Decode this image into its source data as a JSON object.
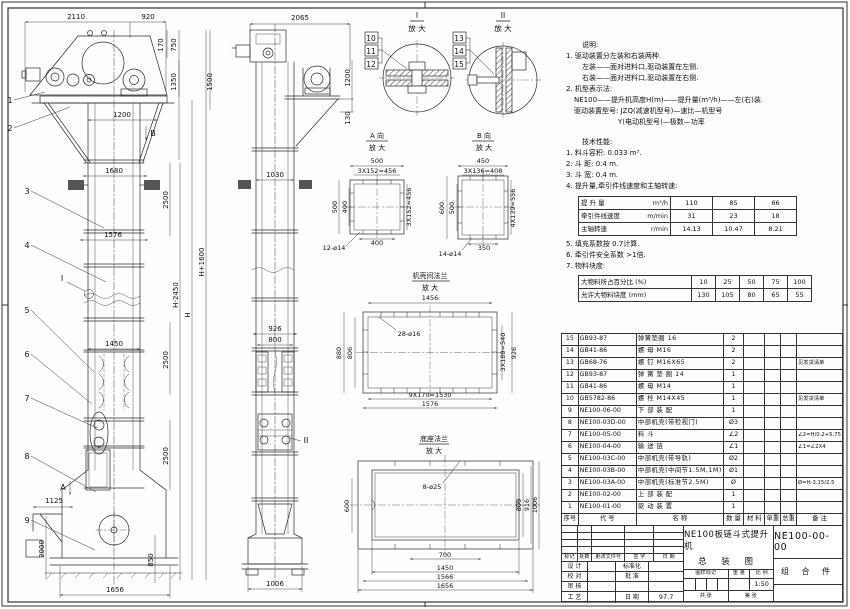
{
  "notes": {
    "heading": "说明:",
    "lines": [
      "1. 驱动装置分左装和右装两种.",
      "左装——面对进料口,驱动装置在左侧.",
      "右装——面对进料口,驱动装置在右侧.",
      "2. 机型表示法:",
      "NE100——提升机高度H(m)——提升量(m³/h)——左(右)装.",
      "驱动装置型号: JZQ(减速机型号)—速比—机型号",
      "Y(电动机型号)—极数—功率"
    ]
  },
  "performance": {
    "heading": "技术性能:",
    "items": [
      "1. 料斗容积: 0.033 m³.",
      "2. 斗  距: 0.4 m.",
      "3. 斗  宽: 0.4 m.",
      "4. 提升量,牵引件线速度和主轴转速:",
      "5. 填充系数按 0.7计算.",
      "6. 牵引件安全系数 >1倍.",
      "7. 物料块度:"
    ],
    "capacity_table": {
      "rows": [
        {
          "label": "提 升 量",
          "unit": "m³/h",
          "v1": "110",
          "v2": "85",
          "v3": "66"
        },
        {
          "label": "牵引件线速度",
          "unit": "m/min",
          "v1": "31",
          "v2": "23",
          "v3": "18"
        },
        {
          "label": "主轴转速",
          "unit": "r/min",
          "v1": "14.13",
          "v2": "10.47",
          "v3": "8.21"
        }
      ]
    },
    "lump_table": {
      "row1_label": "大物料所占百分比 (%)",
      "row1": [
        "10",
        "25",
        "50",
        "75",
        "100"
      ],
      "row2_label": "允许大物料块度 (mm)",
      "row2": [
        "130",
        "105",
        "80",
        "65",
        "55"
      ]
    }
  },
  "bom": {
    "headers": {
      "no": "序号",
      "code": "代  号",
      "name": "名    称",
      "qty": "数 量",
      "material": "材  料",
      "unit_weight": "单重",
      "total_weight": "总重",
      "remark": "备 注"
    },
    "rows": [
      {
        "no": "15",
        "code": "GB93-87",
        "name": "弹簧垫圈  16",
        "qty": "2",
        "remark": ""
      },
      {
        "no": "14",
        "code": "GB41-86",
        "name": "螺  母  M16",
        "qty": "2",
        "remark": ""
      },
      {
        "no": "13",
        "code": "GB68-76",
        "name": "螺  钉  M16X65",
        "qty": "2",
        "remark": "见发货清单"
      },
      {
        "no": "12",
        "code": "GB93-87",
        "name": "弹 簧 垫 圈  14",
        "qty": "1",
        "remark": ""
      },
      {
        "no": "11",
        "code": "GB41-86",
        "name": "螺  母  M14",
        "qty": "1",
        "remark": ""
      },
      {
        "no": "10",
        "code": "GB5782-86",
        "name": "螺  栓  M14X45",
        "qty": "1",
        "remark": "见发货清单"
      },
      {
        "no": "9",
        "code": "NE100-06-00",
        "name": "下 部 装 配",
        "qty": "1",
        "remark": ""
      },
      {
        "no": "8",
        "code": "NE100-03D-00",
        "name": "中部机壳(带检视门)",
        "qty": "Ø3",
        "remark": ""
      },
      {
        "no": "7",
        "code": "NE100-05-00",
        "name": "料  斗",
        "qty": "∠2",
        "remark": "∠2=H/0.2+5.75"
      },
      {
        "no": "6",
        "code": "NE100-04-00",
        "name": "输 送 链",
        "qty": "∠1",
        "remark": "∠1=∠2X4"
      },
      {
        "no": "5",
        "code": "NE100-03C-00",
        "name": "中部机壳(带导轨)",
        "qty": "Ø2",
        "remark": ""
      },
      {
        "no": "4",
        "code": "NE100-03B-00",
        "name": "中部机壳(中间节1.5M,1M)",
        "qty": "Ø1",
        "remark": ""
      },
      {
        "no": "3",
        "code": "NE100-03A-00",
        "name": "中部机壳(标准节2.5M)",
        "qty": "Ø",
        "remark": "Ø=H-3.15/2.5"
      },
      {
        "no": "2",
        "code": "NE100-02-00",
        "name": "上 部 装 配",
        "qty": "1",
        "remark": ""
      },
      {
        "no": "1",
        "code": "NE100-01-00",
        "name": "驱 动 装 置",
        "qty": "1",
        "remark": ""
      }
    ]
  },
  "title_block": {
    "product": "NE100板链斗式提升机",
    "doc_type": "总 装 图",
    "drawing_no": "NE100-00-00",
    "assembly": "组 合 件",
    "rev_headers": [
      "标记",
      "处数",
      "更改文件号",
      "签 字",
      "日 期"
    ],
    "roles": {
      "design": "设 计",
      "check": "校 对",
      "review": "审 核",
      "process": "工 艺",
      "standard": "标准化",
      "approve": "批 准",
      "date_label": "日 期",
      "date": "97.7"
    },
    "stamp": {
      "mark": "图样标记",
      "weight": "重 量",
      "scale_label": "比 例",
      "scale": "1:50",
      "sheets": "共  张",
      "sheet_no": "第  张"
    }
  },
  "front": {
    "dims": {
      "w2110": "2110",
      "w920": "920",
      "h170": "170",
      "h750": "750",
      "h1350": "1350",
      "h1500": "1500",
      "w1200": "1200",
      "w1680": "1680",
      "h2500a": "2500",
      "w1576": "1576",
      "hp1600": "H+1600",
      "hm2450": "H-2450",
      "h": "H",
      "w1450": "1450",
      "h2500b": "2500",
      "h2500c": "2500",
      "w1125": "1125",
      "h2000": "2000",
      "h850": "850",
      "w1656": "1656"
    },
    "balloons": [
      "1",
      "2",
      "3",
      "4",
      "5",
      "6",
      "7",
      "8",
      "9"
    ],
    "marker_a": "A",
    "marker_b": "B",
    "detail_ref_i": "I"
  },
  "side": {
    "dims": {
      "w2065": "2065",
      "h1200": "1200",
      "h130": "130",
      "w1030": "1030",
      "w926": "926",
      "w800": "800",
      "w1006": "1006"
    },
    "detail_ref_ii": "II"
  },
  "detail_i": {
    "label": "I",
    "zoom": "放 大",
    "balloons": [
      "10",
      "11",
      "12"
    ]
  },
  "detail_ii": {
    "label": "II",
    "zoom": "放 大",
    "balloons": [
      "13",
      "14",
      "15"
    ]
  },
  "view_a": {
    "title": "A 向",
    "zoom": "放 大",
    "dims": {
      "top": "500",
      "top2": "3X152=456",
      "left": "500",
      "left2": "400",
      "right": "3X152=456",
      "bottom": "400",
      "holes": "12-ø14"
    }
  },
  "view_b": {
    "title": "B 向",
    "zoom": "放 大",
    "dims": {
      "top": "450",
      "top2": "3X136=408",
      "left": "600",
      "left2": "500",
      "right": "4X139=556",
      "bottom": "350",
      "holes": "14-ø14"
    }
  },
  "flange": {
    "title": "机壳间法兰",
    "zoom": "放 大",
    "dims": {
      "top": "1456",
      "holes": "28-ø16",
      "left": "880",
      "left2": "806",
      "right": "3X180=540",
      "right2": "926",
      "bottom": "9X170=1530",
      "bottom2": "1576"
    }
  },
  "base": {
    "title": "底座法兰",
    "zoom": "放 大",
    "dims": {
      "holes": "8-ø25",
      "left": "600",
      "right": "800",
      "right2": "916",
      "right3": "1006",
      "bottom1": "700",
      "bottom2": "1450",
      "bottom3": "1566",
      "bottom4": "1656"
    }
  }
}
